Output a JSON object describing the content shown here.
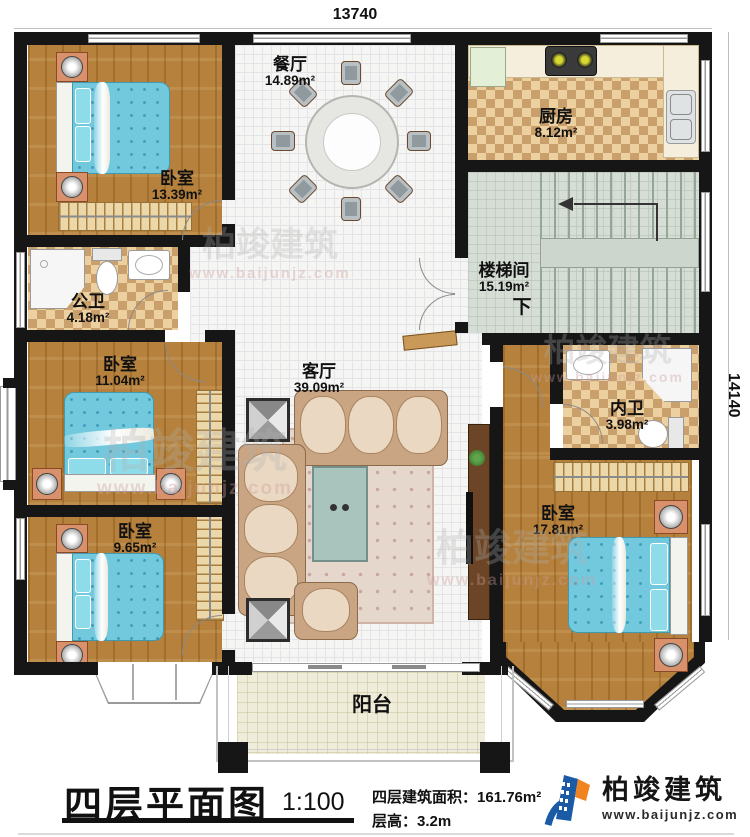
{
  "dims": {
    "top": "13740",
    "right": "14140"
  },
  "rooms": {
    "bedroom_tl": {
      "name": "卧室",
      "area": "13.39m²"
    },
    "dining": {
      "name": "餐厅",
      "area": "14.89m²"
    },
    "kitchen": {
      "name": "厨房",
      "area": "8.12m²"
    },
    "stairwell": {
      "name": "楼梯间",
      "area": "15.19m²",
      "down": "下"
    },
    "bath_public": {
      "name": "公卫",
      "area": "4.18m²"
    },
    "bedroom_ml": {
      "name": "卧室",
      "area": "11.04m²"
    },
    "living": {
      "name": "客厅",
      "area": "39.09m²"
    },
    "bath_private": {
      "name": "内卫",
      "area": "3.98m²"
    },
    "bedroom_bl": {
      "name": "卧室",
      "area": "9.65m²"
    },
    "bedroom_br": {
      "name": "卧室",
      "area": "17.81m²"
    },
    "balcony": {
      "name": "阳台"
    }
  },
  "footer": {
    "plan_title": "四层平面图",
    "scale": "1:100",
    "area_label": "四层建筑面积：",
    "area_value": "161.76m²",
    "height_label": "层高：",
    "height_value": "3.2m",
    "brand": "柏竣建筑",
    "website": "www.baijunjz.com"
  },
  "watermark": {
    "brand": "柏竣建筑",
    "website": "www.baijunjz.com"
  },
  "colors": {
    "wall": "#161616",
    "wood_floor": "#b5813c",
    "bed_blue": "#72c9de",
    "checker_dark": "#c99f6b",
    "checker_light": "#ecd0a0",
    "logo_blue": "#1b5ba6",
    "logo_orange": "#ef8420"
  }
}
